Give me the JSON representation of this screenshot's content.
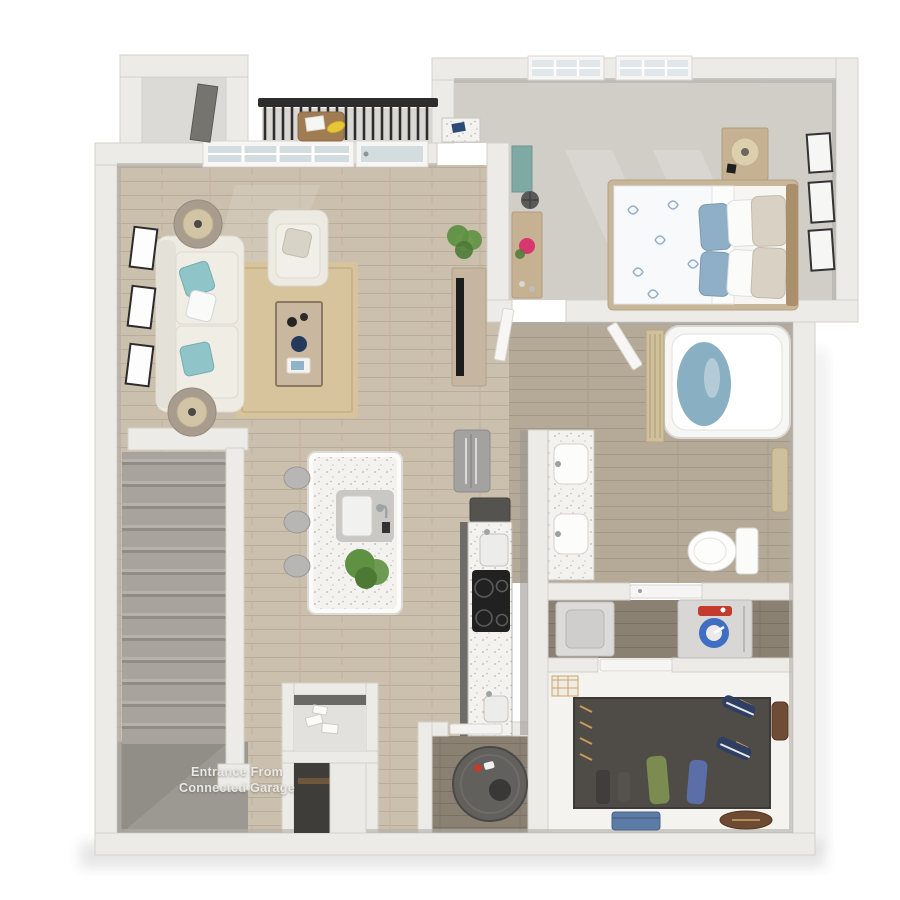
{
  "label": {
    "entrance_line1": "Entrance From",
    "entrance_line2": "Connected Garage"
  },
  "palette": {
    "background": "#ffffff",
    "wall": "#edebe7",
    "wall_edge": "#d3d0cb",
    "wall_face": "#b2afa9",
    "concrete": "#9c9993",
    "rug": "#d8c49c",
    "sofa": "#eeebe3",
    "accent_teal": "#8fc4c8",
    "carpet": "#d1cec8",
    "bed_blue": "#8fafc6",
    "water_blue": "#7fa9bd",
    "curtain_tan": "#cfc09d",
    "washer_dial_blue": "#3f6ec2",
    "detergent_red": "#c23b2e",
    "closet_dark": "#4f4c48",
    "denim_blue": "#5c7ca6",
    "bag_brown": "#6f4c35",
    "railing_dark": "#2d2d2d",
    "tv_black": "#1c1c1c",
    "plant_green": "#5e9141",
    "flower_pink": "#d8366e",
    "cooktop_black": "#212121",
    "heater_gray": "#62605d",
    "label_text": "#e9e8e4"
  },
  "scene": {
    "type": "3d-floor-plan-render",
    "rooms": [
      {
        "name": "living-room",
        "items": [
          "sofa",
          "teal-accent-pillows",
          "table-lamps",
          "side-tables",
          "armchair",
          "coffee-table",
          "jute-rug",
          "gallery-frames",
          "tv-console",
          "flat-tv",
          "potted-fern",
          "picture-window",
          "balcony-glass-door",
          "pony-wall"
        ]
      },
      {
        "name": "balcony",
        "items": [
          "metal-railing",
          "wood-chair",
          "book",
          "bananas"
        ]
      },
      {
        "name": "entry-porch",
        "items": [
          "front-door"
        ]
      },
      {
        "name": "bedroom",
        "items": [
          "bed",
          "floral-duvet",
          "pillow-stack",
          "nightstand",
          "table-lamp",
          "alarm-clock",
          "gallery-frames",
          "dresser",
          "pink-flowers",
          "teal-desk",
          "desk-chair",
          "double-windows"
        ]
      },
      {
        "name": "bathroom",
        "items": [
          "soaking-tub",
          "shower-curtain",
          "vanity",
          "twin-sinks",
          "toilet",
          "hand-towel"
        ]
      },
      {
        "name": "hallway",
        "items": [
          "bedroom-door",
          "bathroom-door"
        ]
      },
      {
        "name": "kitchen",
        "items": [
          "island",
          "island-sink",
          "faucet",
          "herb-plant",
          "bar-stools",
          "refrigerator",
          "wall-cabinet",
          "counter-run",
          "prep-sink",
          "cooktop"
        ]
      },
      {
        "name": "laundry-closet",
        "items": [
          "dryer",
          "washer",
          "detergent-tray",
          "bifold-door"
        ]
      },
      {
        "name": "walk-in-closet",
        "items": [
          "wrap-shelving",
          "hanging-clothes",
          "folded-jeans",
          "handbag",
          "storage-box",
          "striped-shoes",
          "wood-sign"
        ]
      },
      {
        "name": "utility-closet",
        "items": [
          "water-heater"
        ]
      },
      {
        "name": "stairwell",
        "items": [
          "carpeted-stairs",
          "railing-wall",
          "newel-post",
          "concrete-landing"
        ]
      },
      {
        "name": "pantry-closet",
        "items": [
          "display-shelf",
          "slider-door"
        ]
      }
    ]
  }
}
